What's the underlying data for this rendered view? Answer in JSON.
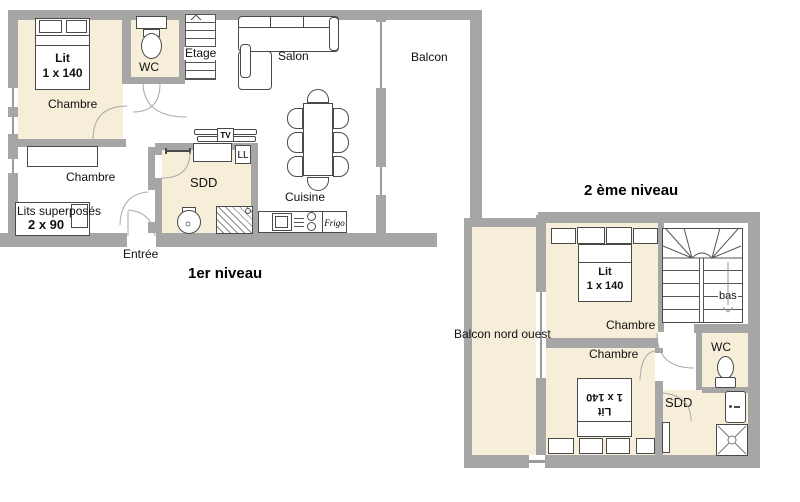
{
  "colors": {
    "wall": "#a6a6a6",
    "room_fill": "#f6eed9",
    "line": "#4a4a4a"
  },
  "floor1": {
    "title": "1er niveau",
    "bedroom1_label": "Chambre",
    "bed_label_line1": "Lit",
    "bed_label_line2": "1 x 140",
    "wc_label": "WC",
    "stairs_label": "Etage",
    "salon_label": "Salon",
    "balcony_label": "Balcon",
    "sdd_label": "SDD",
    "washer_label": "LL",
    "tv_label": "TV",
    "kitchen_label": "Cuisine",
    "fridge_label": "Frigo",
    "bedroom2_label": "Chambre",
    "bunk_label_line1": "Lits superposés",
    "bunk_label_line2": "2 x 90",
    "entrance_label": "Entrée"
  },
  "floor2": {
    "title": "2 ème niveau",
    "balcony_label": "Balcon nord ouest",
    "bedroom1_label": "Chambre",
    "bed1_label_line1": "Lit",
    "bed1_label_line2": "1 x 140",
    "stairs_label": "bas",
    "wc_label": "WC",
    "sdd_label": "SDD",
    "bedroom2_label": "Chambre",
    "bed2_label_line1": "Lit",
    "bed2_label_line2": "1 x 140"
  }
}
